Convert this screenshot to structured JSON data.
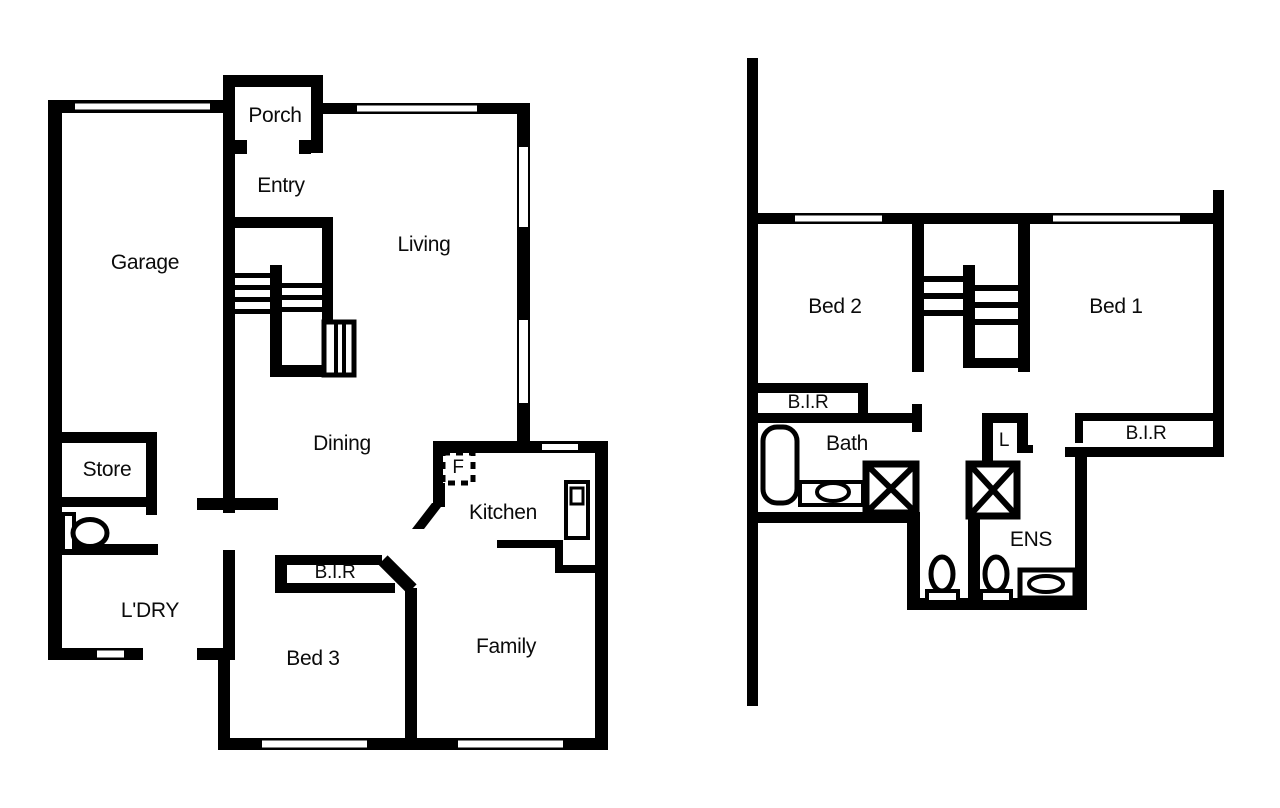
{
  "document": {
    "type": "residential floor plan, two levels",
    "background": "#ffffff",
    "wall_color": "#000000"
  },
  "floors": {
    "ground": {
      "rooms": {
        "porch": "Porch",
        "entry": "Entry",
        "living": "Living",
        "garage": "Garage",
        "dining": "Dining",
        "store": "Store",
        "laundry": "L'DRY",
        "bed3": "Bed 3",
        "bir": "B.I.R",
        "fridge": "F",
        "kitchen": "Kitchen",
        "family": "Family"
      },
      "fixtures": [
        "staircase",
        "toilet",
        "fridge-recess",
        "kitchen-sink",
        "kitchen-bench",
        "windows",
        "door-openings"
      ]
    },
    "upper": {
      "rooms": {
        "bed2": "Bed 2",
        "bed1": "Bed 1",
        "bir_left": "B.I.R",
        "bath": "Bath",
        "linen": "L",
        "bir_right": "B.I.R",
        "ens": "ENS"
      },
      "fixtures": [
        "staircase",
        "bathtub",
        "vanity-basin",
        "shower",
        "toilet",
        "toilet",
        "ensuite-vanity-basin",
        "windows",
        "door-openings"
      ]
    }
  }
}
